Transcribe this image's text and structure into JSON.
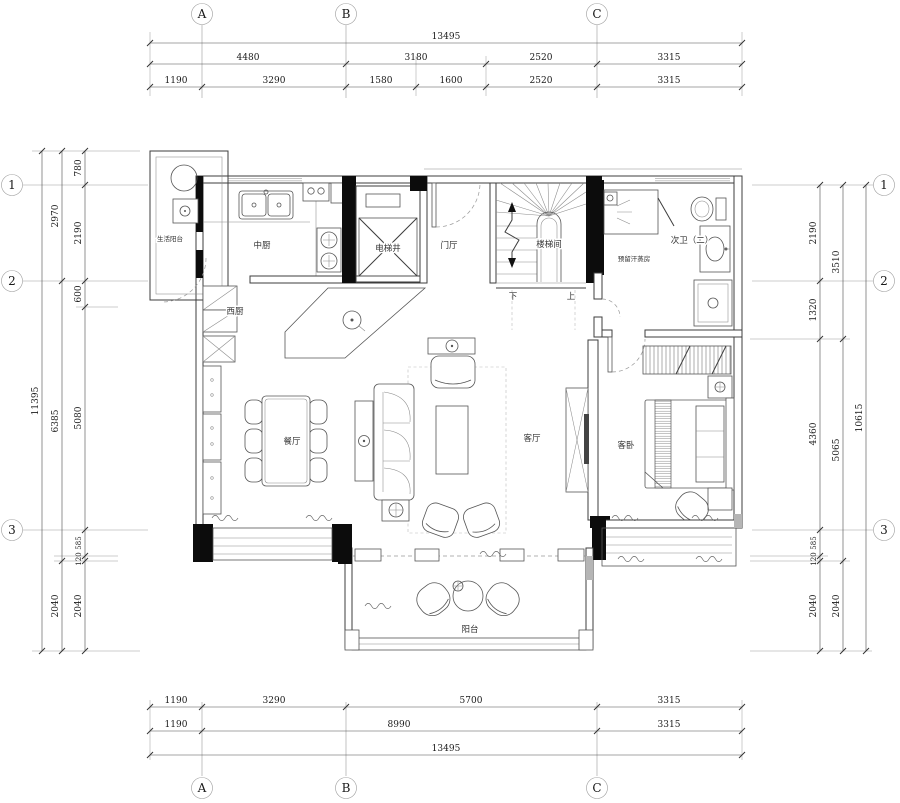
{
  "drawing": {
    "type": "residential floor plan",
    "colors": {
      "background": "#ffffff",
      "linework": "#3c3c3c",
      "structure_fill": "#000000"
    },
    "grid": {
      "cols": [
        "A",
        "B",
        "C"
      ],
      "rows": [
        "1",
        "2",
        "3"
      ]
    },
    "dims": {
      "top_total": "13495",
      "top_r1": [
        "4480",
        "3180",
        "2520",
        "3315"
      ],
      "top_r2": [
        "1190",
        "3290",
        "1580",
        "1600",
        "2520",
        "3315"
      ],
      "bottom_r1": [
        "1190",
        "3290",
        "5700",
        "3315"
      ],
      "bottom_r2": [
        "1190",
        "8990",
        "3315"
      ],
      "bottom_total": "13495",
      "left_total": "11395",
      "left_mid": [
        "2970",
        "6385",
        "2040"
      ],
      "left_inner": [
        "780",
        "2190",
        "600",
        "5080",
        "585",
        "120",
        "2040"
      ],
      "right_total": "10615",
      "right_mid": [
        "3510",
        "5065",
        "2040"
      ],
      "right_inner": [
        "2190",
        "1320",
        "4360",
        "585",
        "120",
        "2040"
      ]
    },
    "rooms": {
      "service_balcony": "生活阳台",
      "kitchen_cn": "中厨",
      "kitchen_w": "西厨",
      "elevator": "电梯井",
      "foyer": "门厅",
      "stairwell": "楼梯间",
      "bath2": "次卫（二）",
      "steam_room": "预留汗蒸房",
      "dining": "餐厅",
      "living": "客厅",
      "guest_bed": "客卧",
      "balcony": "阳台"
    },
    "stairs": {
      "down": "下",
      "up": "上"
    }
  }
}
